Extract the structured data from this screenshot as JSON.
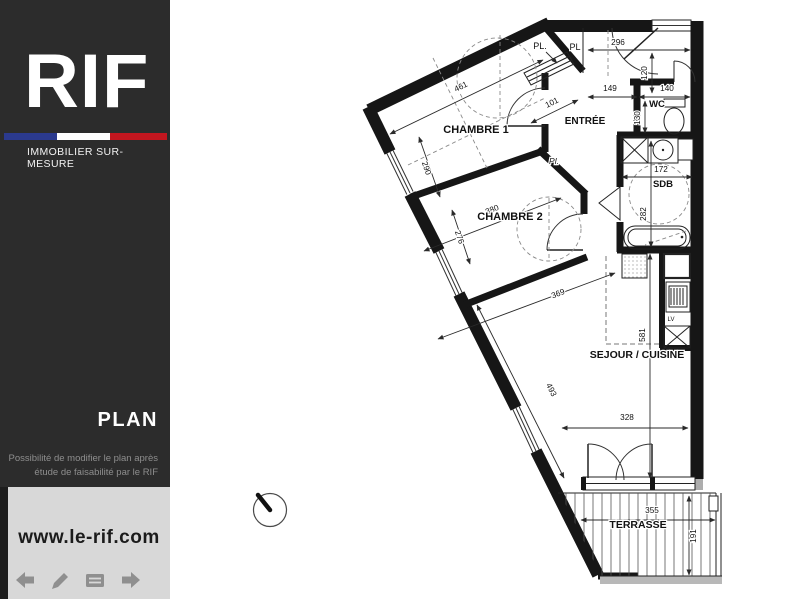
{
  "sidebar": {
    "logo_text": "RIF",
    "tagline": "IMMOBILIER SUR-MESURE",
    "flag": {
      "blue": "#2b3a8e",
      "white": "#ffffff",
      "red": "#c3161f"
    },
    "section_title": "PLAN",
    "note": {
      "line1": "Possibilité de modifier le plan après",
      "line2": "étude de faisabilité par le RIF"
    },
    "website": "www.le-rif.com",
    "toolbar_icons": [
      "back-arrow",
      "pencil",
      "notes",
      "forward-arrow"
    ]
  },
  "plan": {
    "room_labels": [
      {
        "text": "CHAMBRE 1",
        "x": 476,
        "y": 133,
        "size": 11,
        "bold": true
      },
      {
        "text": "CHAMBRE 2",
        "x": 510,
        "y": 220,
        "size": 11,
        "bold": true
      },
      {
        "text": "ENTRÉE",
        "x": 585,
        "y": 124,
        "size": 10,
        "bold": true
      },
      {
        "text": "WC",
        "x": 657,
        "y": 107,
        "size": 9.5,
        "bold": true
      },
      {
        "text": "SDB",
        "x": 663,
        "y": 187,
        "size": 9.5,
        "bold": true
      },
      {
        "text": "SEJOUR / CUISINE",
        "x": 637,
        "y": 358,
        "size": 10.5,
        "bold": true
      },
      {
        "text": "TERRASSE",
        "x": 638,
        "y": 528,
        "size": 10.5,
        "bold": true
      },
      {
        "text": "PL.",
        "x": 540,
        "y": 49,
        "size": 9,
        "bold": false
      },
      {
        "text": "PL",
        "x": 575,
        "y": 50,
        "size": 9,
        "bold": false
      },
      {
        "text": "Pl.",
        "x": 554,
        "y": 164,
        "size": 8.5,
        "bold": false,
        "italic": true
      },
      {
        "text": "LV",
        "x": 671,
        "y": 321,
        "size": 6,
        "bold": false
      }
    ],
    "dimensions": [
      {
        "label": "461",
        "x1": 390,
        "y1": 134,
        "x2": 543,
        "y2": 60,
        "tx": 462,
        "ty": 89,
        "rot": -26
      },
      {
        "label": "290",
        "x1": 419,
        "y1": 137,
        "x2": 440,
        "y2": 197,
        "tx": 424,
        "ty": 169,
        "rot": 71
      },
      {
        "label": "101",
        "x1": 531,
        "y1": 123,
        "x2": 578,
        "y2": 100,
        "tx": 553,
        "ty": 105,
        "rot": -26
      },
      {
        "label": "296",
        "x1": 588,
        "y1": 50,
        "x2": 690,
        "y2": 50,
        "tx": 618,
        "ty": 45,
        "rot": 0
      },
      {
        "label": "120",
        "x1": 652,
        "y1": 53,
        "x2": 652,
        "y2": 93,
        "tx": 647,
        "ty": 73,
        "rot": -90
      },
      {
        "label": "149",
        "x1": 588,
        "y1": 97,
        "x2": 637,
        "y2": 97,
        "tx": 610,
        "ty": 91,
        "rot": 0
      },
      {
        "label": "140",
        "x1": 639,
        "y1": 97,
        "x2": 690,
        "y2": 97,
        "tx": 667,
        "ty": 91,
        "rot": 0
      },
      {
        "label": "130",
        "x1": 645,
        "y1": 101,
        "x2": 645,
        "y2": 133,
        "tx": 640,
        "ty": 118,
        "rot": -90
      },
      {
        "label": "380",
        "x1": 424,
        "y1": 251,
        "x2": 561,
        "y2": 198,
        "tx": 493,
        "ty": 212,
        "rot": -21
      },
      {
        "label": "276",
        "x1": 452,
        "y1": 210,
        "x2": 470,
        "y2": 264,
        "tx": 457,
        "ty": 238,
        "rot": 71
      },
      {
        "label": "172",
        "x1": 622,
        "y1": 177,
        "x2": 692,
        "y2": 177,
        "tx": 661,
        "ty": 172,
        "rot": 0
      },
      {
        "label": "282",
        "x1": 651,
        "y1": 141,
        "x2": 651,
        "y2": 247,
        "tx": 646,
        "ty": 214,
        "rot": -90
      },
      {
        "label": "369",
        "x1": 438,
        "y1": 339,
        "x2": 615,
        "y2": 273,
        "tx": 559,
        "ty": 296,
        "rot": -21
      },
      {
        "label": "581",
        "x1": 650,
        "y1": 254,
        "x2": 650,
        "y2": 478,
        "tx": 645,
        "ty": 335,
        "rot": -90
      },
      {
        "label": "493",
        "x1": 477,
        "y1": 305,
        "x2": 564,
        "y2": 478,
        "tx": 549,
        "ty": 391,
        "rot": 63
      },
      {
        "label": "328",
        "x1": 562,
        "y1": 428,
        "x2": 688,
        "y2": 428,
        "tx": 627,
        "ty": 420,
        "rot": 0
      },
      {
        "label": "355",
        "x1": 581,
        "y1": 520,
        "x2": 715,
        "y2": 520,
        "tx": 652,
        "ty": 513,
        "rot": 0
      },
      {
        "label": "191",
        "x1": 689,
        "y1": 496,
        "x2": 689,
        "y2": 575,
        "tx": 696,
        "ty": 536,
        "rot": -90
      }
    ],
    "compass": {
      "cx": 270,
      "cy": 510,
      "r": 16.5
    }
  }
}
